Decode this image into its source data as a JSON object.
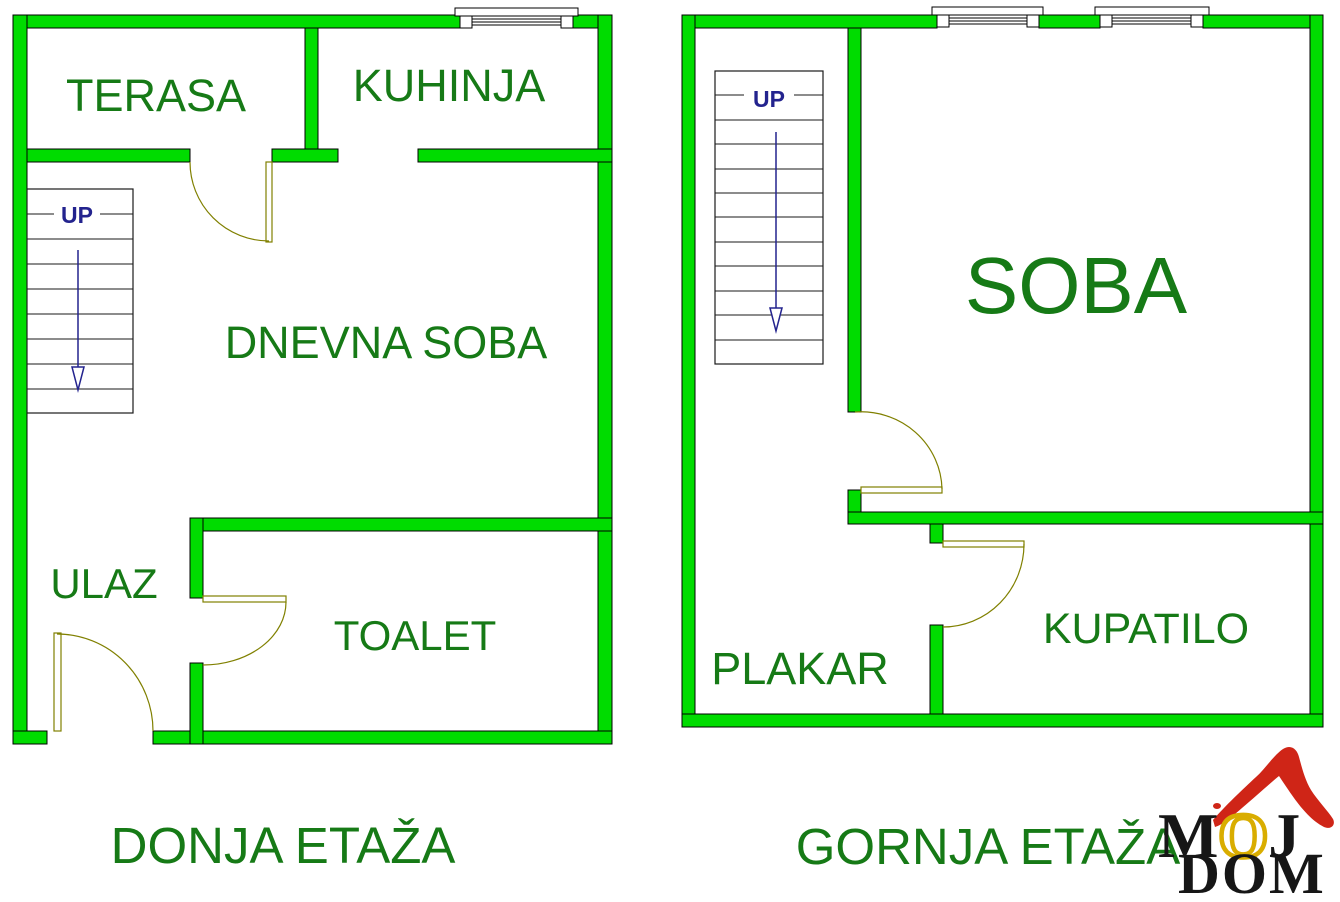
{
  "floors": [
    {
      "title": "DONJA ETAŽA",
      "stairs_label": "UP",
      "rooms": [
        {
          "name": "TERASA"
        },
        {
          "name": "KUHINJA"
        },
        {
          "name": "DNEVNA SOBA"
        },
        {
          "name": "ULAZ"
        },
        {
          "name": "TOALET"
        }
      ]
    },
    {
      "title": "GORNJA ETAŽA",
      "stairs_label": "UP",
      "rooms": [
        {
          "name": "SOBA"
        },
        {
          "name": "PLAKAR"
        },
        {
          "name": "KUPATILO"
        }
      ]
    }
  ],
  "logo": {
    "m": "M",
    "o": "O",
    "j": "J",
    "line2": "DOM"
  },
  "colors": {
    "wall_fill": "#00dc00",
    "label_text": "#167a16",
    "stairs_text": "#23238e",
    "door_swing": "#808000",
    "logo_red": "#cf2517",
    "logo_yellow": "#d9ad00",
    "logo_black": "#161616"
  }
}
